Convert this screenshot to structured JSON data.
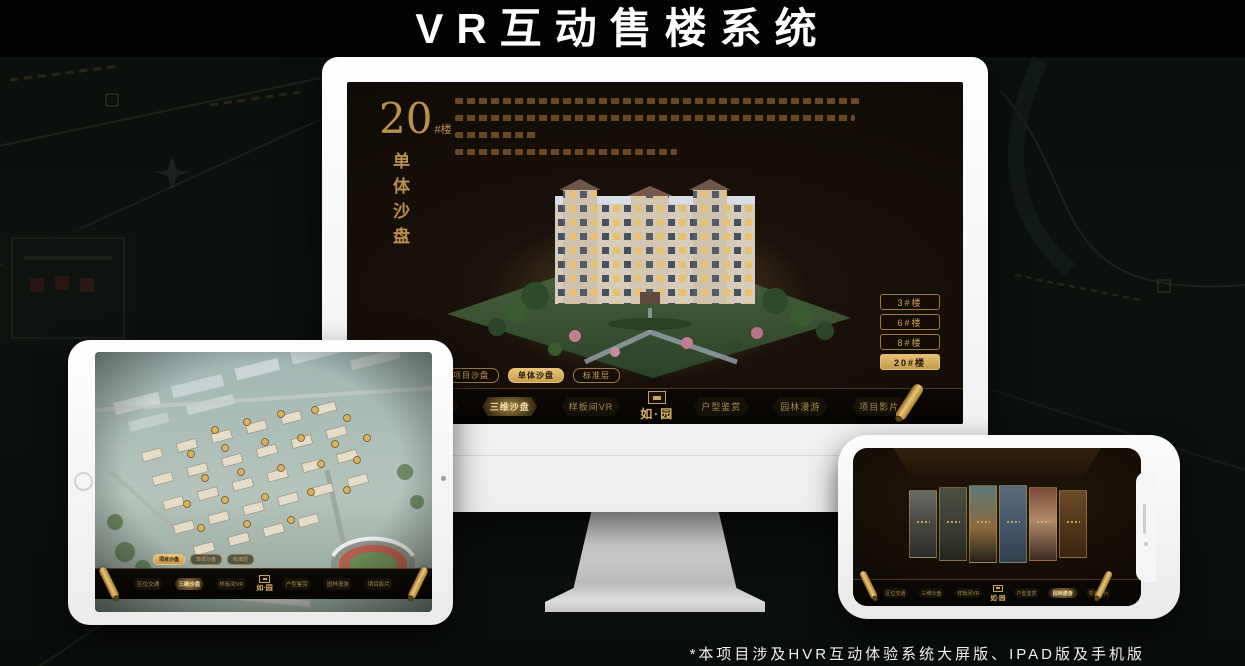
{
  "banner": {
    "title": "VR互动售楼系统"
  },
  "footnote": {
    "text": "*本项目涉及HVR互动体验系统大屏版、IPAD版及手机版"
  },
  "brand": {
    "logo_text": "如·园",
    "seal_icon": "seal-stamp-icon"
  },
  "nav_shared": {
    "left_items": [
      "区位交通",
      "三维沙盘",
      "样板间VR"
    ],
    "right_items": [
      "户型鉴赏",
      "园林漫游",
      "项目影片"
    ],
    "scroll_icon": "scroll-ornament-icon"
  },
  "monitor": {
    "headline": {
      "number": "20",
      "suffix": "#楼",
      "vertical_title": "单体沙盘"
    },
    "floor_buttons": [
      {
        "label": "3#楼",
        "active": false
      },
      {
        "label": "6#楼",
        "active": false
      },
      {
        "label": "8#楼",
        "active": false
      },
      {
        "label": "20#楼",
        "active": true
      }
    ],
    "sub_tabs": [
      {
        "label": "项目沙盘",
        "active": false
      },
      {
        "label": "单体沙盘",
        "active": true
      },
      {
        "label": "标准层",
        "active": false
      }
    ],
    "active_nav": "三维沙盘"
  },
  "tablet": {
    "sub_tabs": [
      {
        "label": "项目沙盘",
        "active": true
      },
      {
        "label": "单体沙盘",
        "active": false
      },
      {
        "label": "标准层",
        "active": false
      }
    ],
    "active_nav": "三维沙盘"
  },
  "phone": {
    "active_nav": "园林漫游",
    "gallery_panel_count": 6
  },
  "colors": {
    "gold": "#c9a25a",
    "gold_bright": "#e8c478",
    "gold_dim": "#7d6233",
    "screen_bg": "#16100a",
    "banner_bg": "#030303",
    "page_bg": "#0b100d",
    "highlight_text_dark": "#241a08"
  }
}
